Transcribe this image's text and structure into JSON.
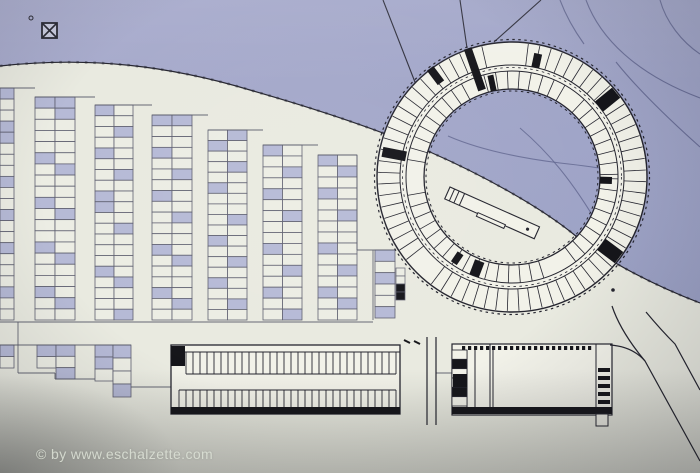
{
  "watermark": {
    "text": "© by www.eschalzette.com"
  },
  "colors": {
    "terrain": "#9aa0c4",
    "terrain_light": "#a9accd",
    "site": "#e9eae0",
    "cell_plain": "#ecede4",
    "cell_shaded": "#b6bad6",
    "cell_stroke": "#5f6070",
    "line_dark": "#24242e",
    "line_medium": "#565868",
    "contour": "#60658e",
    "building_fill": "#f2f2e9",
    "black": "#15151a"
  },
  "plan": {
    "width": 700,
    "height": 473,
    "site_path": "M0,66 C90,56 170,66 250,90 C320,110 382,131 430,152 C478,173 540,206 577,237 C608,262 656,286 700,303 L700,473 L0,473 Z",
    "boundary_path": "M0,66 C90,56 170,66 250,90 C320,110 382,131 430,152 C478,173 540,206 577,237 C608,262 656,286 700,303",
    "contours": [
      "M586,0 C600,38 636,74 700,98",
      "M660,0 C666,22 682,42 700,54",
      "M560,0 C566,16 574,30 584,44",
      "M616,62 C640,92 672,122 700,147"
    ],
    "courtyard_contours": [
      "M448,136 C480,150 520,158 560,163 C578,165 596,167 610,170",
      "M520,128 C548,152 572,180 600,228"
    ],
    "access_lines": [
      [
        383,
        0,
        420,
        95
      ],
      [
        460,
        0,
        467,
        48
      ],
      [
        541,
        0,
        494,
        42
      ]
    ],
    "strips": [
      {
        "x": 0,
        "w": 14,
        "cols": 1,
        "top": 88,
        "bottom": 320,
        "rows": 21,
        "sh": [
          [
            0,
            3,
            4,
            8,
            11,
            14,
            18
          ]
        ]
      },
      {
        "x": 35,
        "w": 40,
        "cols": 2,
        "top": 97,
        "bottom": 320,
        "rows": 20,
        "sh": [
          [
            0,
            5,
            9,
            13,
            17
          ],
          [
            0,
            1,
            6,
            10,
            14,
            18
          ]
        ]
      },
      {
        "x": 95,
        "w": 38,
        "cols": 2,
        "top": 105,
        "bottom": 320,
        "rows": 20,
        "sh": [
          [
            0,
            4,
            8,
            9,
            15
          ],
          [
            2,
            6,
            11,
            16,
            19
          ]
        ]
      },
      {
        "x": 152,
        "w": 40,
        "cols": 2,
        "top": 115,
        "bottom": 320,
        "rows": 19,
        "sh": [
          [
            0,
            3,
            7,
            12,
            16
          ],
          [
            0,
            5,
            9,
            13,
            17
          ]
        ]
      },
      {
        "x": 208,
        "w": 39,
        "cols": 2,
        "top": 130,
        "bottom": 320,
        "rows": 18,
        "sh": [
          [
            1,
            5,
            10,
            14
          ],
          [
            0,
            3,
            8,
            12,
            16
          ]
        ]
      },
      {
        "x": 263,
        "w": 39,
        "cols": 2,
        "top": 145,
        "bottom": 320,
        "rows": 16,
        "sh": [
          [
            0,
            4,
            9,
            13
          ],
          [
            2,
            6,
            11,
            15
          ]
        ]
      },
      {
        "x": 318,
        "w": 39,
        "cols": 2,
        "top": 155,
        "bottom": 320,
        "rows": 15,
        "sh": [
          [
            0,
            3,
            8,
            12
          ],
          [
            1,
            5,
            10,
            13
          ]
        ]
      },
      {
        "x": 375,
        "w": 20,
        "cols": 1,
        "top": 250,
        "bottom": 318,
        "rows": 6,
        "sh": [
          [
            0,
            2,
            5
          ]
        ]
      },
      {
        "x": 0,
        "w": 14,
        "cols": 1,
        "top": 345,
        "bottom": 368,
        "rows": 2,
        "sh": [
          [
            0
          ]
        ]
      },
      {
        "x": 37,
        "w": 19,
        "cols": 1,
        "top": 345,
        "bottom": 368,
        "rows": 2,
        "sh": [
          [
            0
          ]
        ]
      },
      {
        "x": 56,
        "w": 19,
        "cols": 1,
        "top": 345,
        "bottom": 379,
        "rows": 3,
        "sh": [
          [
            0,
            2
          ]
        ]
      },
      {
        "x": 95,
        "w": 18,
        "cols": 1,
        "top": 345,
        "bottom": 381,
        "rows": 3,
        "sh": [
          [
            0,
            1
          ]
        ]
      },
      {
        "x": 113,
        "w": 18,
        "cols": 1,
        "top": 345,
        "bottom": 397,
        "rows": 4,
        "sh": [
          [
            0,
            3
          ]
        ]
      }
    ],
    "kiosk": {
      "x": 396,
      "w": 9,
      "top": 268,
      "bottom": 300,
      "rows": 4,
      "dark": [
        2,
        3
      ]
    },
    "lines": [
      [
        0,
        88,
        35,
        88
      ],
      [
        35,
        97,
        95,
        97
      ],
      [
        95,
        105,
        152,
        105
      ],
      [
        152,
        115,
        208,
        115
      ],
      [
        208,
        130,
        263,
        130
      ],
      [
        263,
        145,
        318,
        145
      ],
      [
        318,
        155,
        357,
        155
      ],
      [
        357,
        155,
        357,
        250
      ],
      [
        357,
        250,
        396,
        250
      ],
      [
        373,
        250,
        373,
        320
      ],
      [
        0,
        322,
        373,
        322
      ],
      [
        0,
        345,
        131,
        345
      ],
      [
        18,
        322,
        18,
        373
      ],
      [
        18,
        373,
        55,
        373
      ],
      [
        55,
        373,
        55,
        379
      ],
      [
        55,
        379,
        95,
        379
      ],
      [
        131,
        387,
        171,
        387
      ],
      [
        436,
        373,
        453,
        373
      ]
    ],
    "ring": {
      "cx": 512,
      "cy": 177,
      "r_fill_outer": 135,
      "r_fill_inner": 88,
      "circles_solid": [
        [
          135,
          1.4
        ],
        [
          112,
          1.0
        ],
        [
          106,
          1.0
        ],
        [
          88,
          1.3
        ]
      ],
      "circles_dashed": [
        [
          137.5,
          1.2
        ],
        [
          86,
          1.0
        ],
        [
          109.5,
          0.8
        ]
      ],
      "band1": {
        "r1": 112,
        "r2": 134,
        "step": 5,
        "offset": 2,
        "gaps": [
          [
            258,
            274
          ],
          [
            128,
            138
          ]
        ]
      },
      "band2": {
        "r1": 88,
        "r2": 106,
        "step": 6.5,
        "offset": 1,
        "gaps": [
          [
            242,
            254
          ],
          [
            58,
            70
          ],
          [
            174,
            184
          ],
          [
            300,
            308
          ]
        ]
      },
      "cores": [
        {
          "a": 321,
          "r1": 112,
          "r2": 134,
          "w": 13
        },
        {
          "a": 37,
          "r1": 112,
          "r2": 134,
          "w": 14
        },
        {
          "a": 191,
          "r1": 108,
          "r2": 132,
          "w": 10
        },
        {
          "a": 251,
          "r1": 92,
          "r2": 136,
          "w": 8
        },
        {
          "a": 233,
          "r1": 118,
          "r2": 136,
          "w": 8
        },
        {
          "a": 111,
          "r1": 90,
          "r2": 106,
          "w": 10
        },
        {
          "a": 124,
          "r1": 92,
          "r2": 104,
          "w": 7
        },
        {
          "a": 2,
          "r1": 88,
          "r2": 100,
          "w": 7
        },
        {
          "a": 258,
          "r1": 88,
          "r2": 104,
          "w": 6
        },
        {
          "a": 282,
          "r1": 112,
          "r2": 126,
          "w": 8
        }
      ]
    },
    "slab": {
      "x": 450,
      "y": 187,
      "angle": 24,
      "len": 98,
      "h": 13,
      "parts": [
        5,
        10,
        16
      ],
      "notch": [
        36,
        30,
        4
      ],
      "dot": [
        88,
        7
      ]
    },
    "long_building": {
      "rect": [
        171,
        345,
        229,
        69
      ],
      "h_lines": [
        [
          171,
          352,
          400,
          352
        ],
        [
          186,
          374,
          396,
          374
        ],
        [
          179,
          390,
          396,
          390
        ],
        [
          179,
          408,
          396,
          408
        ]
      ],
      "bands": [
        {
          "x0": 186,
          "x1": 396,
          "step": 7,
          "y0": 352,
          "y1": 374
        },
        {
          "x0": 179,
          "x1": 396,
          "step": 7,
          "y0": 390,
          "y1": 408
        }
      ],
      "dark_rects": [
        [
          171,
          346,
          14,
          20
        ],
        [
          171,
          407,
          229,
          7
        ]
      ],
      "ticks": [
        [
          404,
          340,
          410,
          343
        ],
        [
          414,
          341,
          420,
          344
        ]
      ]
    },
    "right_building": {
      "rect": [
        452,
        344,
        160,
        71
      ],
      "v_lines": [
        [
          467,
          350,
          467,
          407
        ],
        [
          475,
          350,
          475,
          407
        ],
        [
          490,
          344,
          490,
          414
        ],
        [
          493,
          350,
          493,
          407
        ],
        [
          596,
          344,
          596,
          414
        ]
      ],
      "hatch": {
        "x0": 462,
        "x1": 592,
        "y": 346,
        "dw": 3.2,
        "dh": 4,
        "step": 6
      },
      "left_cells": {
        "x": 452,
        "w": 15,
        "top": 350,
        "bottom": 406,
        "rows": 6,
        "dark": [
          1,
          4
        ]
      },
      "blob": [
        453,
        374,
        14,
        13
      ],
      "stair": {
        "x": 598,
        "w": 12,
        "top": 368,
        "bars": 5,
        "bh": 4,
        "gap": 4
      },
      "bottom": [
        452,
        407,
        160,
        7
      ],
      "foot": [
        596,
        414,
        12,
        12
      ]
    },
    "roads": [
      "M610,345 C626,346 637,352 645,361 L700,461",
      "M612,306 C618,324 630,343 645,361",
      "M646,312 C656,324 666,335 675,344 L700,390",
      "M427,337 L427,425",
      "M436,337 L436,425"
    ],
    "dots": [
      [
        613,
        290
      ]
    ],
    "north_marker": {
      "x": 42,
      "y": 23,
      "s": 15,
      "dot": [
        31,
        18
      ]
    }
  }
}
